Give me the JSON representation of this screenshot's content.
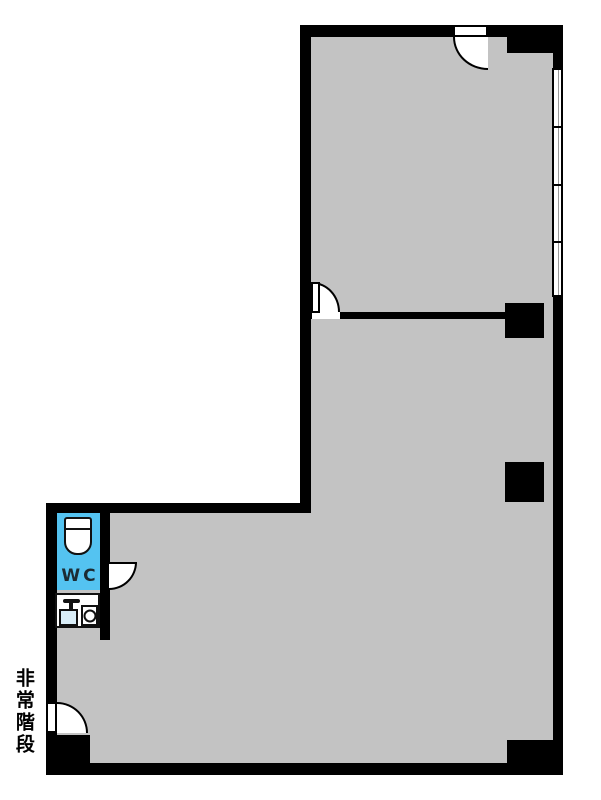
{
  "document": {
    "type": "floor-plan",
    "background": "#ffffff"
  },
  "colors": {
    "bg": "#ffffff",
    "wall": "#000000",
    "floor": "#c3c3c3",
    "wcfill": "#54c3f1",
    "sinkfill": "#daeef8"
  },
  "labels": {
    "wc": "WC",
    "emergency_stairs": "非常階段"
  },
  "features": {
    "rooms": [
      "main-l-shaped-room",
      "upper-room",
      "wc"
    ],
    "doors": [
      "top-entrance-door",
      "partition-door",
      "wc-door",
      "emergency-exit-door"
    ],
    "window_panes": 4,
    "pillars": 2,
    "fixtures": [
      "toilet",
      "sink-with-faucet",
      "washing-machine-pan"
    ]
  }
}
